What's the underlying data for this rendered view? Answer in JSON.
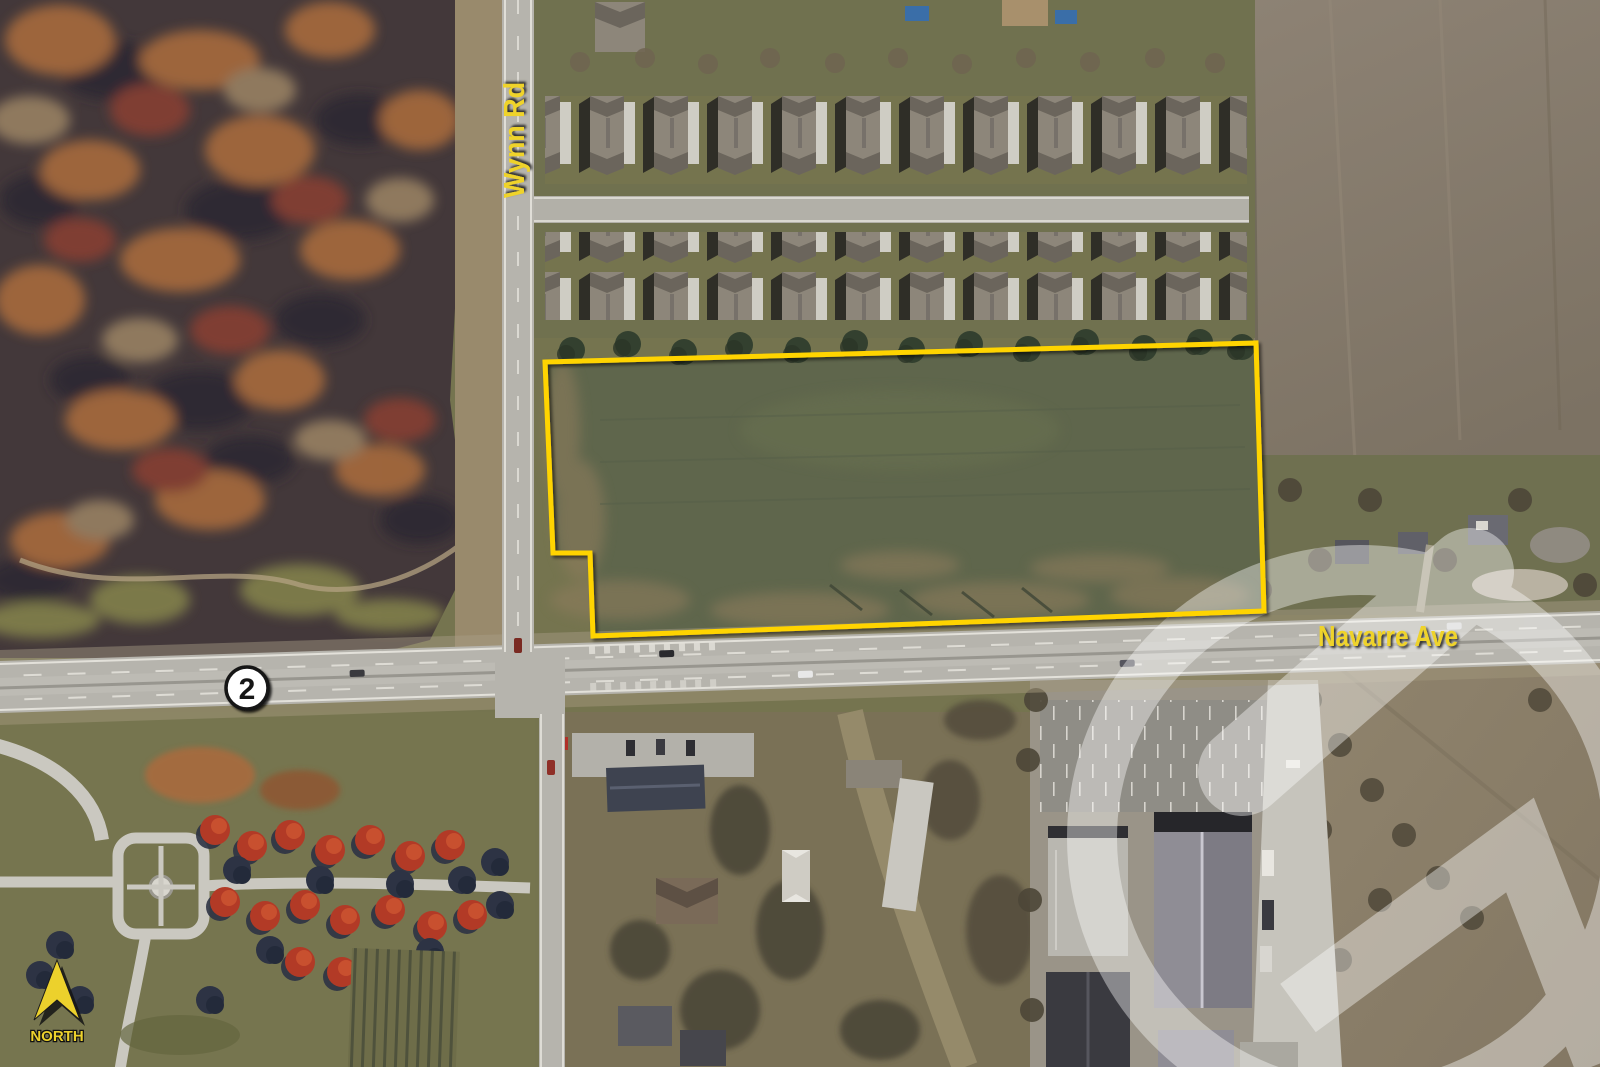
{
  "title": "Aerial parcel map",
  "map": {
    "road_labels": {
      "vertical": "Wynn Rd",
      "horizontal": "Navarre Ave"
    },
    "route_shield": {
      "number": "2"
    },
    "compass": {
      "label": "NORTH"
    },
    "parcel_outline": {
      "points": "545,362 1256,343 1264,611 593,636 590,553 553,553",
      "color": "#FFD400"
    },
    "annotation_colors": {
      "label_yellow": "#EFD32B",
      "shield_fill": "#FFFFFF",
      "shield_border": "#141414",
      "shield_text": "#141414",
      "north_yellow": "#ECD12C"
    }
  }
}
